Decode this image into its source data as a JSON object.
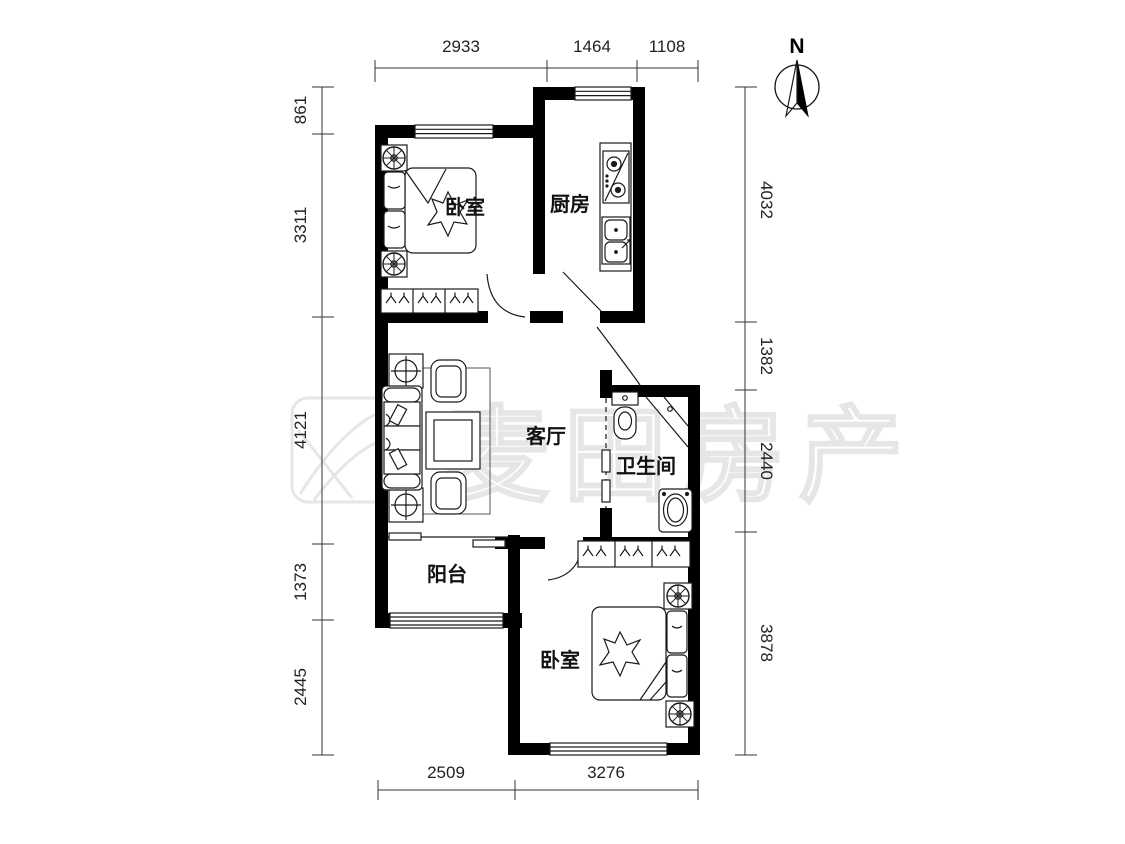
{
  "watermark": {
    "text": "麦田房产"
  },
  "compass": {
    "label": "N"
  },
  "rooms": {
    "bedroom1": "卧室",
    "kitchen": "厨房",
    "living": "客厅",
    "bathroom": "卫生间",
    "balcony": "阳台",
    "bedroom2": "卧室"
  },
  "dimensions": {
    "top": [
      "2933",
      "1464",
      "1108"
    ],
    "left": [
      "861",
      "3311",
      "4121",
      "1373",
      "2445"
    ],
    "right": [
      "4032",
      "1382",
      "2440",
      "3878"
    ],
    "bottom": [
      "2509",
      "3276"
    ]
  },
  "colors": {
    "wall": "#000000",
    "line": "#1a1a1a",
    "dim": "#333333",
    "watermark": "#9a9a9a"
  }
}
